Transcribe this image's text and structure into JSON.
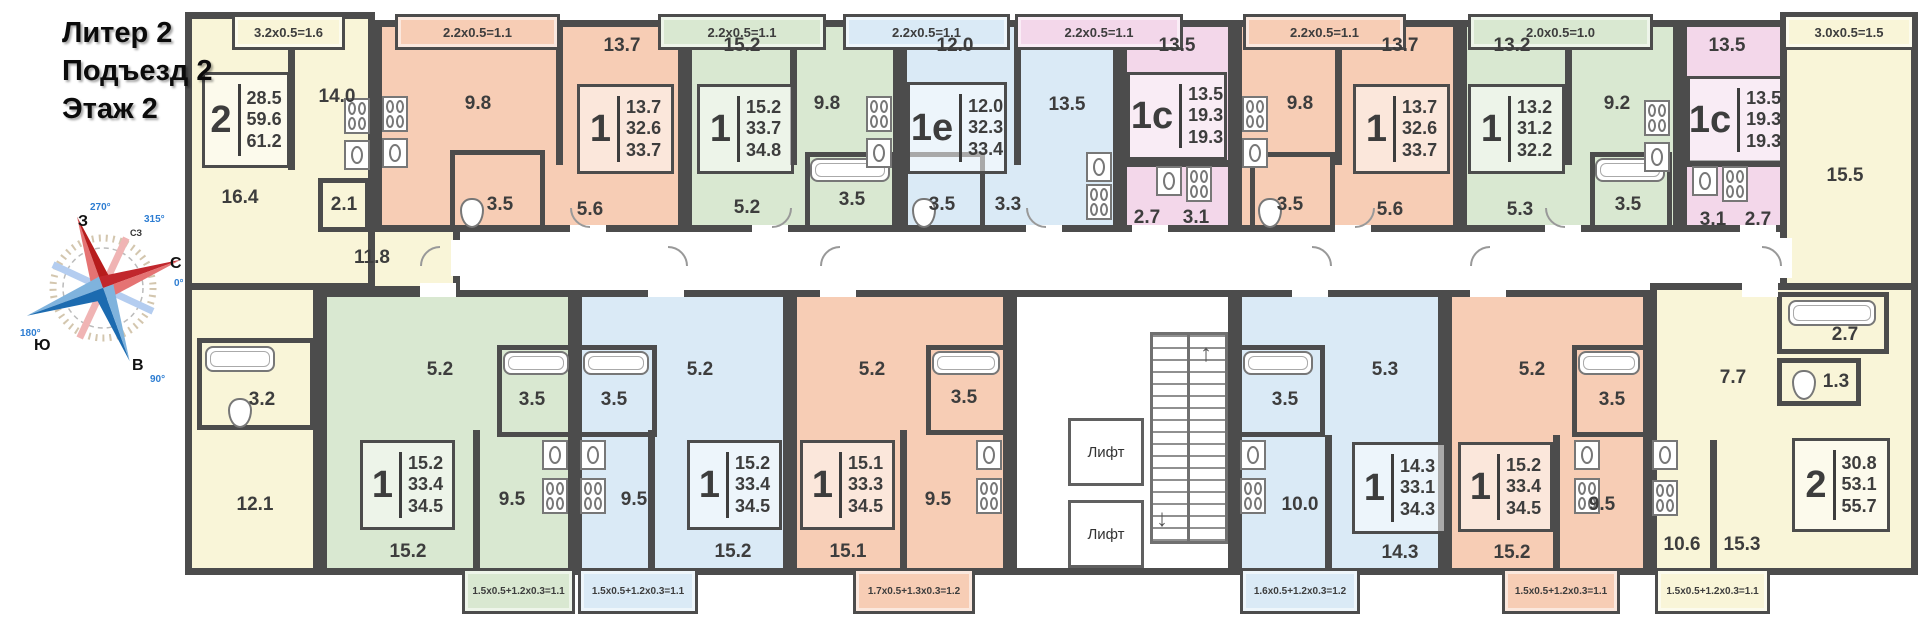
{
  "title": {
    "line1": "Литер 2",
    "line2": "Подъезд 2",
    "line3": "Этаж 2"
  },
  "compass": {
    "west": "З",
    "north": "С",
    "south": "Ю",
    "east": "В",
    "nw": "СЗ",
    "deg_west": "270°",
    "deg_north": "0°",
    "deg_south": "180°",
    "deg_east": "90°",
    "deg_nw": "315°"
  },
  "elevators": {
    "label1": "Лифт",
    "label2": "Лифт"
  },
  "colors": {
    "wall": "#4c4c4c",
    "text": "#3d3d3d",
    "yellow": "#f9f5d8",
    "salmon": "#f7cdb5",
    "green": "#d9e8d1",
    "blue": "#daeaf6",
    "pink": "#f3d7ea",
    "accent_red": "#c1272d",
    "accent_blue": "#1c6bb0"
  },
  "apartments": {
    "aL": {
      "type": "2",
      "area1": "28.5",
      "area2": "59.6",
      "area3": "61.2",
      "balcony": "3.2x0.5=1.6",
      "room1": "16.4",
      "kitchen": "14.0",
      "hall": "11.8",
      "closet": "2.1",
      "bath": "3.2",
      "room2": "12.1"
    },
    "t1": {
      "type": "1",
      "area1": "13.7",
      "area2": "32.6",
      "area3": "33.7",
      "balcony": "2.2x0.5=1.1",
      "kitchen": "9.8",
      "room": "13.7",
      "bath": "3.5",
      "hall": "5.6"
    },
    "t2": {
      "type": "1",
      "area1": "15.2",
      "area2": "33.7",
      "area3": "34.8",
      "balcony": "2.2x0.5=1.1",
      "room": "15.2",
      "kitchen": "9.8",
      "bath": "3.5",
      "hall": "5.2"
    },
    "t3": {
      "type": "1е",
      "area1": "12.0",
      "area2": "32.3",
      "area3": "33.4",
      "balcony": "2.2x0.5=1.1",
      "room": "12.0",
      "kitchen": "13.5",
      "bath": "3.5",
      "hall": "3.3"
    },
    "t4": {
      "type": "1с",
      "area1": "13.5",
      "area2": "19.3",
      "area3": "19.3",
      "balcony": "2.2x0.5=1.1",
      "room": "13.5",
      "hall": "2.7",
      "bath": "3.1"
    },
    "t5": {
      "type": "1",
      "area1": "13.7",
      "area2": "32.6",
      "area3": "33.7",
      "balcony": "2.2x0.5=1.1",
      "kitchen": "9.8",
      "room": "13.7",
      "bath": "3.5",
      "hall": "5.6"
    },
    "t6": {
      "type": "1",
      "area1": "13.2",
      "area2": "31.2",
      "area3": "32.2",
      "balcony": "2.0x0.5=1.0",
      "room": "13.2",
      "kitchen": "9.2",
      "hall": "5.3",
      "bath": "3.5"
    },
    "t7": {
      "type": "1с",
      "area1": "13.5",
      "area2": "19.3",
      "area3": "19.3",
      "room": "13.5",
      "bath": "3.1",
      "hall": "2.7"
    },
    "aR": {
      "type": "2",
      "area1": "30.8",
      "area2": "53.1",
      "area3": "55.7",
      "balcony_top": "3.0x0.5=1.5",
      "balcony_bottom": "1.5x0.5+1.2x0.3=1.1",
      "room1": "15.5",
      "bath": "2.7",
      "wc": "1.3",
      "hall": "7.7",
      "kitchen": "10.6",
      "room2": "15.3"
    },
    "b1": {
      "type": "1",
      "area1": "15.2",
      "area2": "33.4",
      "area3": "34.5",
      "balcony": "1.5x0.5+1.2x0.3=1.1",
      "hall": "5.2",
      "bath": "3.5",
      "kitchen": "9.5",
      "room": "15.2"
    },
    "b2": {
      "type": "1",
      "area1": "15.2",
      "area2": "33.4",
      "area3": "34.5",
      "balcony": "1.5x0.5+1.2x0.3=1.1",
      "hall": "5.2",
      "bath": "3.5",
      "kitchen": "9.5",
      "room": "15.2"
    },
    "b3": {
      "type": "1",
      "area1": "15.1",
      "area2": "33.3",
      "area3": "34.5",
      "balcony": "1.7x0.5+1.3x0.3=1.2",
      "hall": "5.2",
      "bath": "3.5",
      "kitchen": "9.5",
      "room": "15.1"
    },
    "b4": {
      "type": "1",
      "area1": "14.3",
      "area2": "33.1",
      "area3": "34.3",
      "balcony": "1.6x0.5+1.2x0.3=1.2",
      "hall": "5.3",
      "bath": "3.5",
      "kitchen": "10.0",
      "room": "14.3"
    },
    "b5": {
      "type": "1",
      "area1": "15.2",
      "area2": "33.4",
      "area3": "34.5",
      "balcony": "1.5x0.5+1.2x0.3=1.1",
      "hall": "5.2",
      "bath": "3.5",
      "kitchen": "9.5",
      "room": "15.2"
    }
  }
}
